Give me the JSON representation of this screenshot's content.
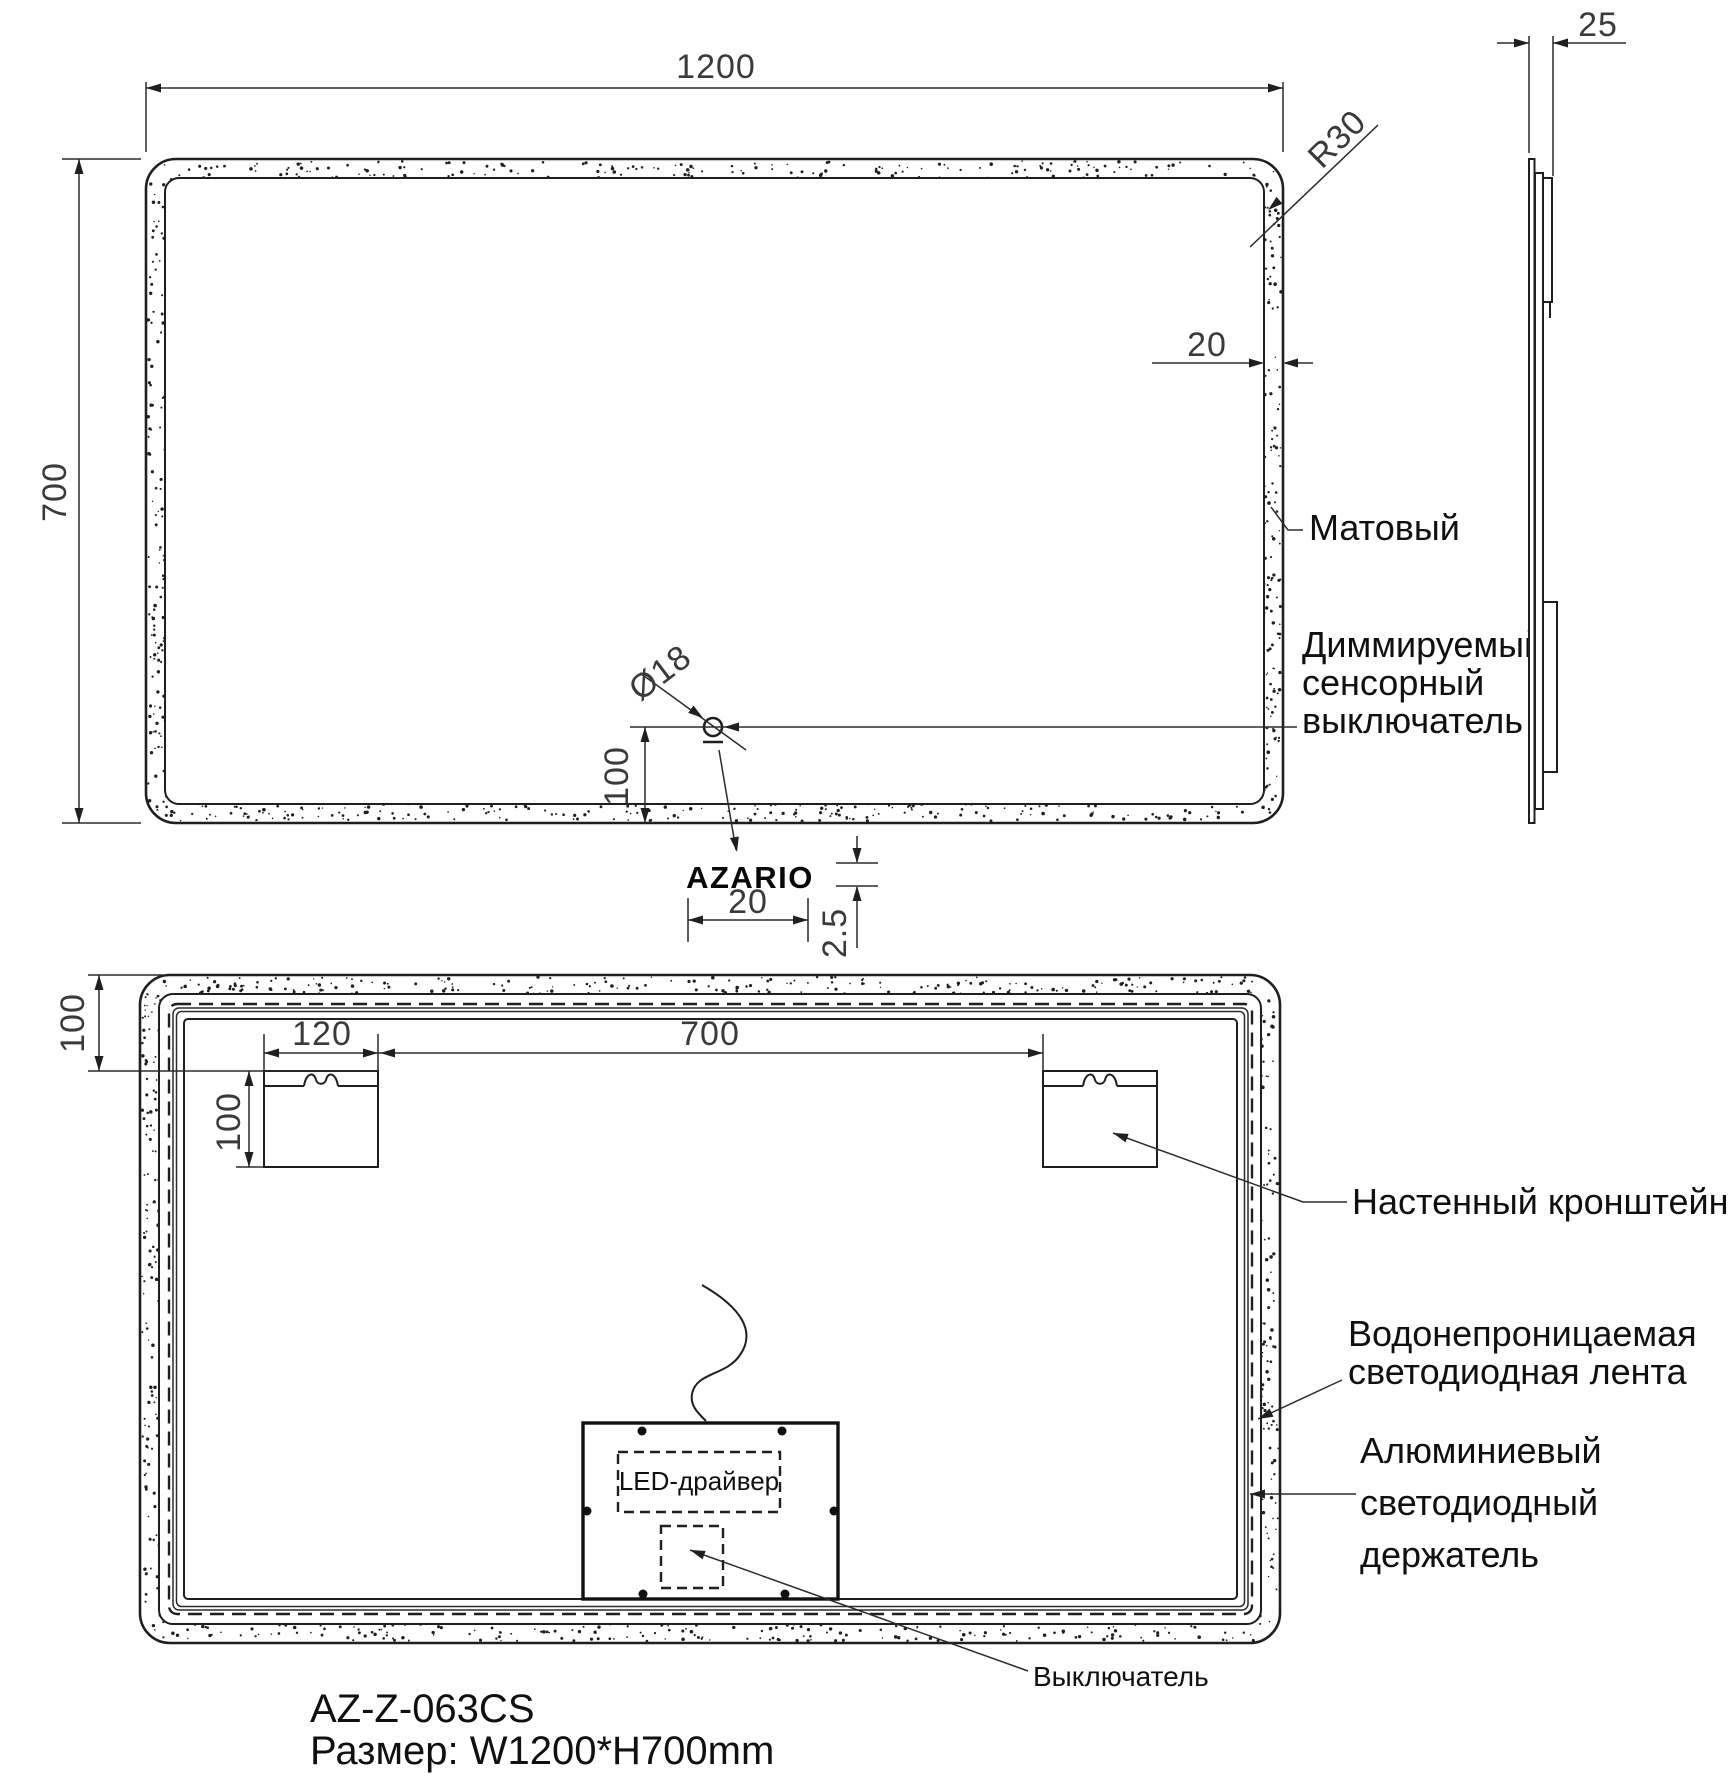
{
  "drawing": {
    "brand_logo": "AZARIO",
    "model": "AZ-Z-063CS",
    "size_line": "Размер: W1200*H700mm"
  },
  "front": {
    "width": "1200",
    "height": "700",
    "corner_radius": "R30",
    "frame_width": "20",
    "sensor_diameter": "Ø18",
    "sensor_offset": "100",
    "logo_width": "20",
    "logo_height": "2.5",
    "label_matte": "Матовый",
    "label_switch_1": "Диммируемый",
    "label_switch_2": "сенсорный",
    "label_switch_3": "выключатель"
  },
  "side": {
    "thickness": "25"
  },
  "rear": {
    "edge_offset": "100",
    "bracket_width": "120",
    "bracket_height": "100",
    "bracket_spacing": "700",
    "label_bracket": "Настенный кронштейн",
    "label_strip_1": "Водонепроницаемая",
    "label_strip_2": "светодиодная лента",
    "label_holder_1": "Алюминиевый",
    "label_holder_2": "светодиодный",
    "label_holder_3": "держатель",
    "label_driver": "LED-драйвер",
    "label_switch": "Выключатель"
  }
}
